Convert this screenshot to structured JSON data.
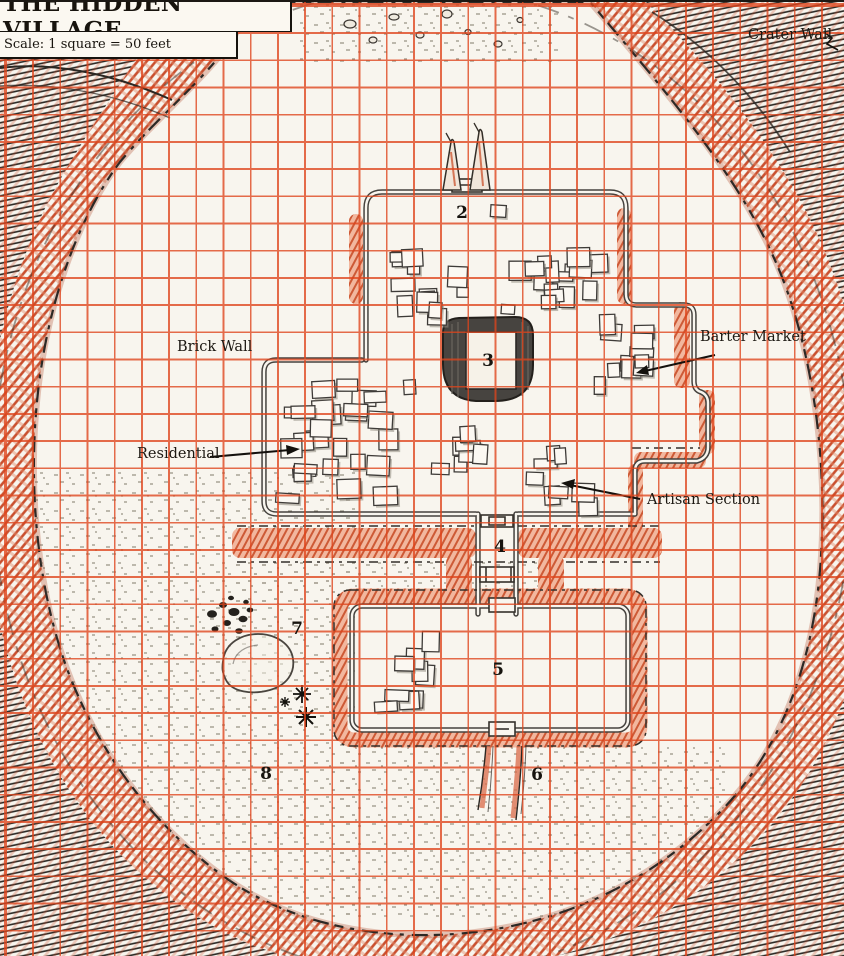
{
  "map_title": "THE HIDDEN VILLAGE",
  "scale_note": "Scale: 1 square = 50 feet",
  "labels": {
    "crater_wall": "Crater Wall",
    "brick_wall": "Brick Wall",
    "residential": "Residential",
    "barter_market": "Barter Market",
    "artisan_section": "Artisan Section"
  },
  "location_numbers": {
    "n2": "2",
    "n3": "3",
    "n4": "4",
    "n5": "5",
    "n6": "6",
    "n7": "7",
    "n8": "8"
  },
  "icons": {
    "crater_wall_pointer": "zigzag-arrow-icon",
    "label_pointer": "arrow-line-icon"
  },
  "colors": {
    "grid_red": "#df441b",
    "paper": "#f8f5ee",
    "rim_hatch_red": "#c94f2e",
    "corner_hatch_black": "#2f2c28",
    "rampart_salmon": "#f2b79e",
    "rampart_stripe": "#cd5a36",
    "ink": "#1c1812"
  }
}
